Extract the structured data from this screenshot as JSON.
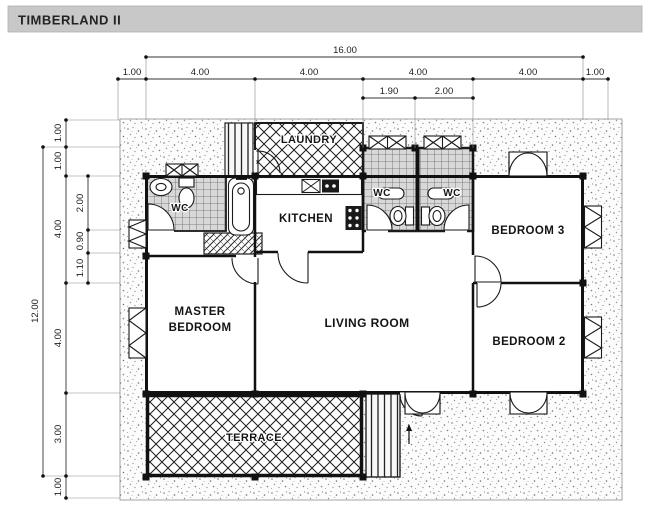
{
  "title": "TIMBERLAND II",
  "dims": {
    "top_total": "16.00",
    "top_row": [
      "1.00",
      "4.00",
      "4.00",
      "4.00",
      "4.00",
      "1.00"
    ],
    "top_sub": [
      "1.90",
      "2.00"
    ],
    "left_total": "12.00",
    "left_col": [
      "1.00",
      "1.00",
      "4.00",
      "4.00",
      "3.00",
      "1.00"
    ],
    "left_sub": [
      "2.00",
      "0.90",
      "1.10"
    ]
  },
  "rooms": {
    "laundry": "LAUNDRY",
    "kitchen": "KITCHEN",
    "wc_master": "WC",
    "wc_1": "WC",
    "wc_2": "WC",
    "bedroom3": "BEDROOM 3",
    "master_line1": "MASTER",
    "master_line2": "BEDROOM",
    "living": "LIVING ROOM",
    "bedroom2": "BEDROOM 2",
    "terrace": "TERRACE"
  },
  "colors": {
    "title_bar": "#c8c8c8",
    "wall": "#111111",
    "dim_line": "#333333",
    "tile_bg": "#d8d8d8",
    "paper": "#ffffff"
  }
}
